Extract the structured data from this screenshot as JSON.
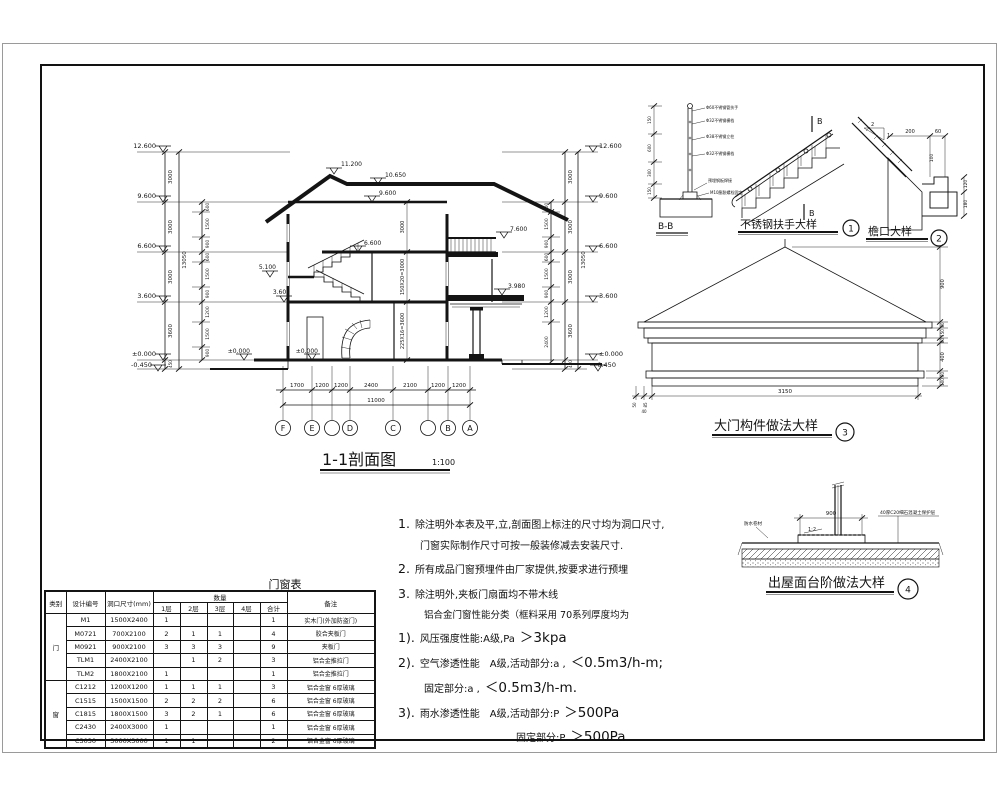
{
  "section": {
    "title": "1-1剖面图",
    "scale": "1:100",
    "lv": [
      "12.600",
      "9.600",
      "6.600",
      "3.600",
      "±0.000",
      "-0.450"
    ],
    "chain": [
      "3000",
      "3000",
      "3000",
      "3600",
      "450"
    ],
    "total": "13050",
    "subL": [
      "600",
      "1500",
      "900",
      "600",
      "1500",
      "900",
      "1200",
      "1500",
      "900"
    ],
    "subR": [
      "600",
      "1500",
      "900",
      "600",
      "1500",
      "900",
      "1200",
      "2400"
    ],
    "marks": {
      "peak": "11.200",
      "ridge": "10.650",
      "attic": "9.600",
      "balc": "7.600",
      "f3": "6.600",
      "land": "5.100",
      "f2": "3.600",
      "canopy": "3.980",
      "g1": "±0.000",
      "g2": "±0.000"
    },
    "inter": [
      "3000",
      "150X20=3000",
      "225X16=3600"
    ],
    "bd": [
      "1700",
      "1200",
      "1200",
      "2400",
      "2100",
      "1200",
      "1200"
    ],
    "bt": "11000",
    "grid": [
      "F",
      "E",
      "D",
      "C",
      "B",
      "A"
    ]
  },
  "d1": {
    "bb": "B-B",
    "bmark": "B",
    "title": "不锈钢扶手大样",
    "num": "1",
    "dims": [
      "150",
      "600",
      "300",
      "150"
    ],
    "labels": [
      "Φ60不锈钢管扶手",
      "Φ32不锈钢横档",
      "Φ38不锈钢立柱",
      "Φ32不锈钢横档",
      "预埋钢板焊接",
      "M10膨胀螺栓固定"
    ]
  },
  "d2": {
    "title": "檐口大样",
    "num": "2",
    "d200": "200",
    "d60": "60",
    "d100": "100",
    "d120": "120",
    "d180": "180",
    "s2": "2",
    "s1": "1"
  },
  "d3": {
    "title": "大门构件做法大样",
    "num": "3",
    "w": "3150",
    "side": [
      "900",
      "80",
      "150",
      "80",
      "400",
      "80",
      "100"
    ],
    "small": [
      "50",
      "85",
      "40"
    ]
  },
  "d4": {
    "title": "出屋面台阶做法大样",
    "num": "4",
    "dim": "900",
    "slope": "1:2",
    "lbl_left": "防水卷材",
    "lbl_right": "40厚C20细石混凝土保护层"
  },
  "notes": {
    "n1": "1.",
    "n1a": "除注明外本表及平,立,剖面图上标注的尺寸均为洞口尺寸,",
    "n1b": "门窗实际制作尺寸可按一般装修减去安装尺寸.",
    "n2": "2.",
    "n2a": "所有成品门窗预埋件由厂家提供,按要求进行预埋",
    "n3": "3.",
    "n3a": "除注明外,夹板门扇面均不带木线",
    "intro": "铝合金门窗性能分类（框料采用 70系列厚度均为",
    "p1": "1).",
    "p1a": "风压强度性能:A级,Pa",
    "p1v": "＞3kpa",
    "p2": "2).",
    "p2a": "空气渗透性能　A级,活动部分:a ,",
    "p2v": "＜0.5m3/h-m;",
    "p2b": "固定部分:a ,",
    "p2bv": "＜0.5m3/h-m.",
    "p3": "3).",
    "p3a": "雨水渗透性能　A级,活动部分:P",
    "p3v": "＞500Pa",
    "p3b": "固定部分:P",
    "p3bv": "＞500Pa"
  },
  "table": {
    "title": "门窗表",
    "h": {
      "cat": "类别",
      "code": "设计编号",
      "size": "洞口尺寸(mm)",
      "qty": "数量",
      "f1": "1层",
      "f2": "2层",
      "f3": "3层",
      "f4": "4层",
      "sum": "合计",
      "rem": "备注"
    },
    "cat1": "门",
    "cat2": "窗",
    "rows": [
      [
        "M1",
        "1500X2400",
        "1",
        "",
        "",
        "",
        "1",
        "实木门(外加防盗门)"
      ],
      [
        "M0721",
        "700X2100",
        "2",
        "1",
        "1",
        "",
        "4",
        "胶合夹板门"
      ],
      [
        "M0921",
        "900X2100",
        "3",
        "3",
        "3",
        "",
        "9",
        "夹板门"
      ],
      [
        "TLM1",
        "2400X2100",
        "",
        "1",
        "2",
        "",
        "3",
        "铝合金推拉门"
      ],
      [
        "TLM2",
        "1800X2100",
        "1",
        "",
        "",
        "",
        "1",
        "铝合金推拉门"
      ],
      [
        "C1212",
        "1200X1200",
        "1",
        "1",
        "1",
        "",
        "3",
        "铝合金窗 6厚玻璃"
      ],
      [
        "C1515",
        "1500X1500",
        "2",
        "2",
        "2",
        "",
        "6",
        "铝合金窗 6厚玻璃"
      ],
      [
        "C1815",
        "1800X1500",
        "3",
        "2",
        "1",
        "",
        "6",
        "铝合金窗 6厚玻璃"
      ],
      [
        "C2430",
        "2400X3000",
        "1",
        "",
        "",
        "",
        "1",
        "铝合金窗 6厚玻璃"
      ],
      [
        "C3030",
        "3000X3000",
        "1",
        "1",
        "",
        "",
        "2",
        "铝合金窗 6厚玻璃"
      ]
    ]
  }
}
